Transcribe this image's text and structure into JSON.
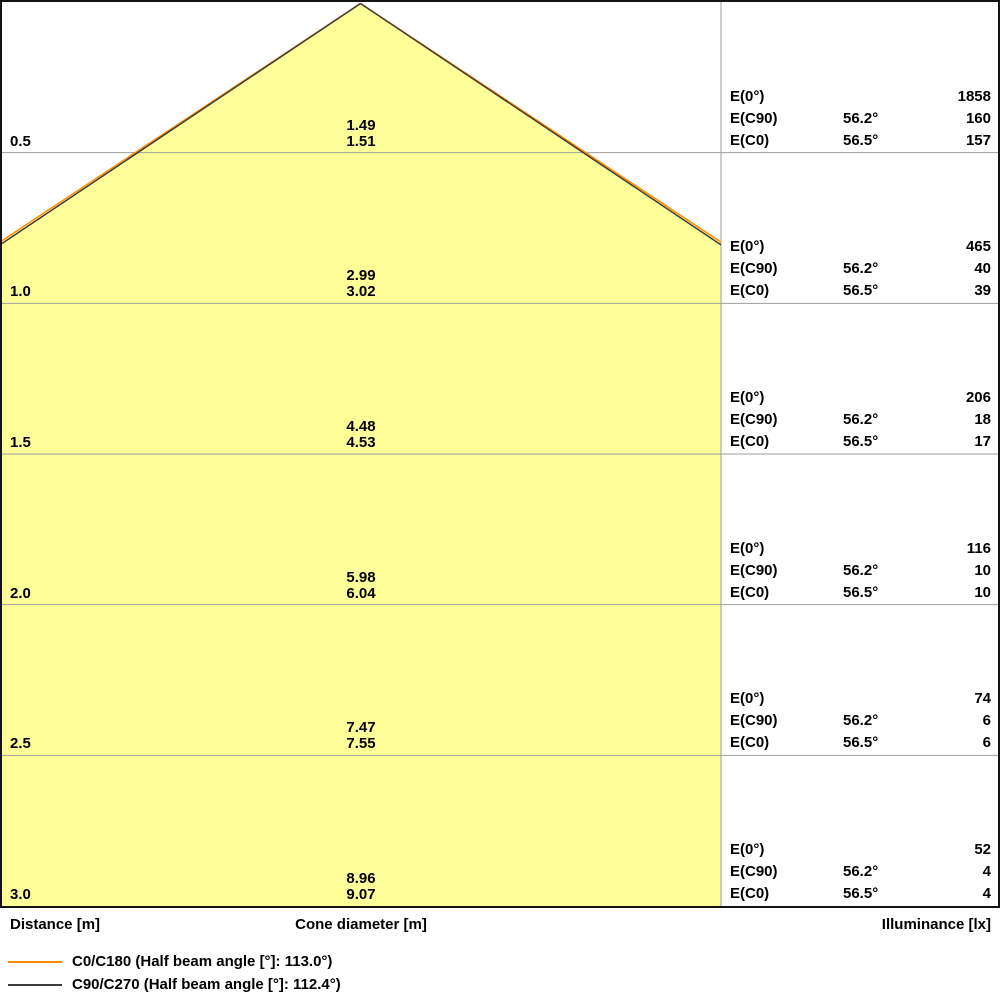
{
  "chart_data": {
    "type": "area",
    "title": "Light cone diagram",
    "axis_labels": {
      "distance": "Distance [m]",
      "cone_diameter": "Cone diameter [m]",
      "illuminance": "Illuminance [lx]"
    },
    "distances_m": [
      0.5,
      1.0,
      1.5,
      2.0,
      2.5,
      3.0
    ],
    "series": [
      {
        "name": "C0/C180",
        "legend_label": "C0/C180 (Half beam angle [°]: 113.0°)",
        "half_beam_angle_deg": 113.0,
        "half_angle_label": "56.5°",
        "color": "#FF8C00",
        "cone_diameter_m": [
          1.51,
          3.02,
          4.53,
          6.04,
          7.55,
          9.07
        ],
        "illuminance_lx": [
          157,
          39,
          17,
          10,
          6,
          4
        ]
      },
      {
        "name": "C90/C270",
        "legend_label": "C90/C270 (Half beam angle [°]: 112.4°)",
        "half_beam_angle_deg": 112.4,
        "half_angle_label": "56.2°",
        "color": "#3C3C3C",
        "cone_diameter_m": [
          1.49,
          2.99,
          4.48,
          5.98,
          7.47,
          8.96
        ],
        "illuminance_lx": [
          160,
          40,
          18,
          10,
          6,
          4
        ]
      }
    ],
    "illuminance_E0_lx": [
      1858,
      465,
      206,
      116,
      74,
      52
    ],
    "colors": {
      "cone_fill": "#FFFF99",
      "grid": "#9E9E9E",
      "border": "#141414",
      "background": "#FFFFFF"
    },
    "layout": {
      "rows": 6,
      "panel_divider_x": 721,
      "apex_x": 360.5,
      "grid": "horizontal",
      "legend_position": "bottom-left"
    }
  },
  "labels": {
    "e0": "E(0°)",
    "ec90": "E(C90)",
    "ec0": "E(C0)",
    "angle_c90": "56.2°",
    "angle_c0": "56.5°"
  },
  "rows": [
    {
      "distance": "0.5",
      "diam": [
        "1.49",
        "1.51"
      ],
      "e0": "1858",
      "ec90": "160",
      "ec0": "157"
    },
    {
      "distance": "1.0",
      "diam": [
        "2.99",
        "3.02"
      ],
      "e0": "465",
      "ec90": "40",
      "ec0": "39"
    },
    {
      "distance": "1.5",
      "diam": [
        "4.48",
        "4.53"
      ],
      "e0": "206",
      "ec90": "18",
      "ec0": "17"
    },
    {
      "distance": "2.0",
      "diam": [
        "5.98",
        "6.04"
      ],
      "e0": "116",
      "ec90": "10",
      "ec0": "10"
    },
    {
      "distance": "2.5",
      "diam": [
        "7.47",
        "7.55"
      ],
      "e0": "74",
      "ec90": "6",
      "ec0": "6"
    },
    {
      "distance": "3.0",
      "diam": [
        "8.96",
        "9.07"
      ],
      "e0": "52",
      "ec90": "4",
      "ec0": "4"
    }
  ]
}
